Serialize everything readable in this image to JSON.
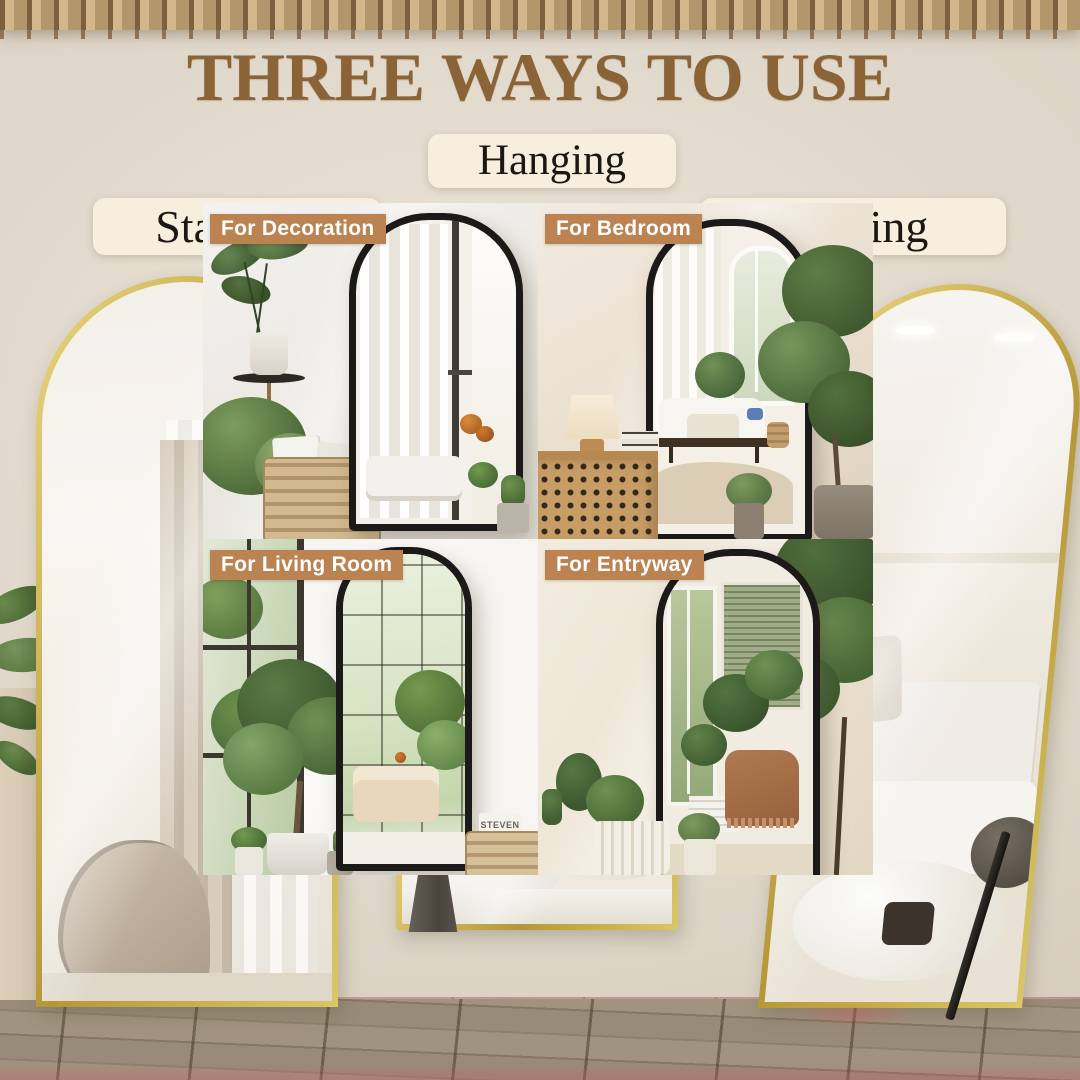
{
  "image_title": "THREE WAYS TO USE",
  "usage_badges": {
    "left": "Standing",
    "center": "Hanging",
    "right": "Leaning"
  },
  "tiles": [
    {
      "label": "For Decoration"
    },
    {
      "label": "For Bedroom"
    },
    {
      "label": "For Living Room",
      "basket_text": "STEVEN"
    },
    {
      "label": "For Entryway"
    }
  ],
  "colors": {
    "title_text": "#8a6336",
    "badge_background": "#f7eedd",
    "badge_text": "#1b1712",
    "tile_label_background": "#bb8351",
    "tile_label_text": "#ffffff",
    "mirror_frame_gold": "#c9ac52",
    "mirror_frame_black": "#1b1a18"
  }
}
